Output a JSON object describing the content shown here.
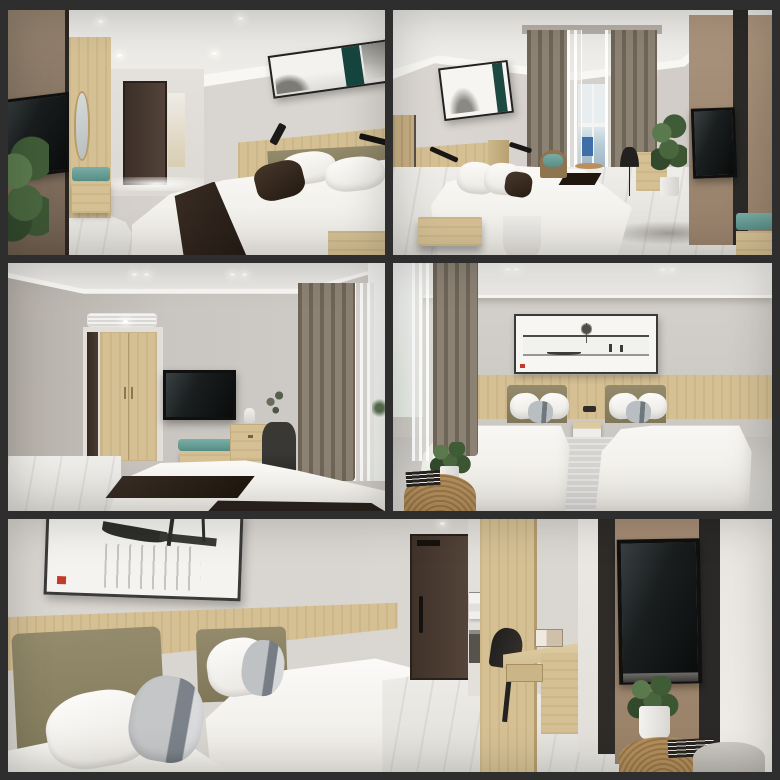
{
  "collage": {
    "title": "hotel-guest-room-render-collage",
    "layout": {
      "rows": 3,
      "panel_count": 5,
      "frame_color": "#2e2e2e"
    },
    "panels": [
      {
        "id": "top-left",
        "scene": "king room: olive headboard bed with dark throw, panoramic ink artwork with teal band, taupe media wall with TV, oak wardrobe, teal luggage bench, entry door, floor plant"
      },
      {
        "id": "top-right",
        "scene": "king room toward window: brown drapes with sheer, rattan chair and side table, writing desk, tall potted plant, TV on taupe panel, teal bench, oak nightstand"
      },
      {
        "id": "middle-left",
        "scene": "view from bed: wall-mounted TV, oak wardrobe by entry, AC ceiling vent, teal bench, desk with chair, curtained bright window, white bed with dark runner"
      },
      {
        "id": "middle-right",
        "scene": "twin room: two olive-headboard single beds, framed ink village painting, shared nightstand, brown drapes, rattan side table with books and potted plant"
      },
      {
        "id": "bottom",
        "scene": "twin-bed close-up: gray accent pillows, ink boat painting with red seal, entry door, bath nook with towels, desk and chair, large TV on taupe panel, rattan table with plant and books, lounge chair"
      }
    ]
  },
  "palette": {
    "frame": "#2e2e2e",
    "wall": "#d8d4cf",
    "wallmid": "#c7c2bc",
    "ceil": "#edebe7",
    "cove": "#f8f7f4",
    "wood": "#d5c094",
    "wooddark": "#c3ab7e",
    "olive": "#8a8164",
    "taupe": "#a18a74",
    "brownwall": "#8d7c6d",
    "door": "#47392f",
    "tv": "#121414",
    "teal": "#66a098",
    "curtain": "#8b8274",
    "curtaindk": "#6e6557",
    "sheer": "#e7e5e1",
    "bed": "#f6f4f0",
    "throw": "#2f261f",
    "pillowgray": "#a8adb2",
    "floor": "#e7e5e1",
    "plant": "#46603c",
    "rattan": "#b28e5c",
    "seal": "#c23b2a",
    "sky": "#eef2f3"
  }
}
